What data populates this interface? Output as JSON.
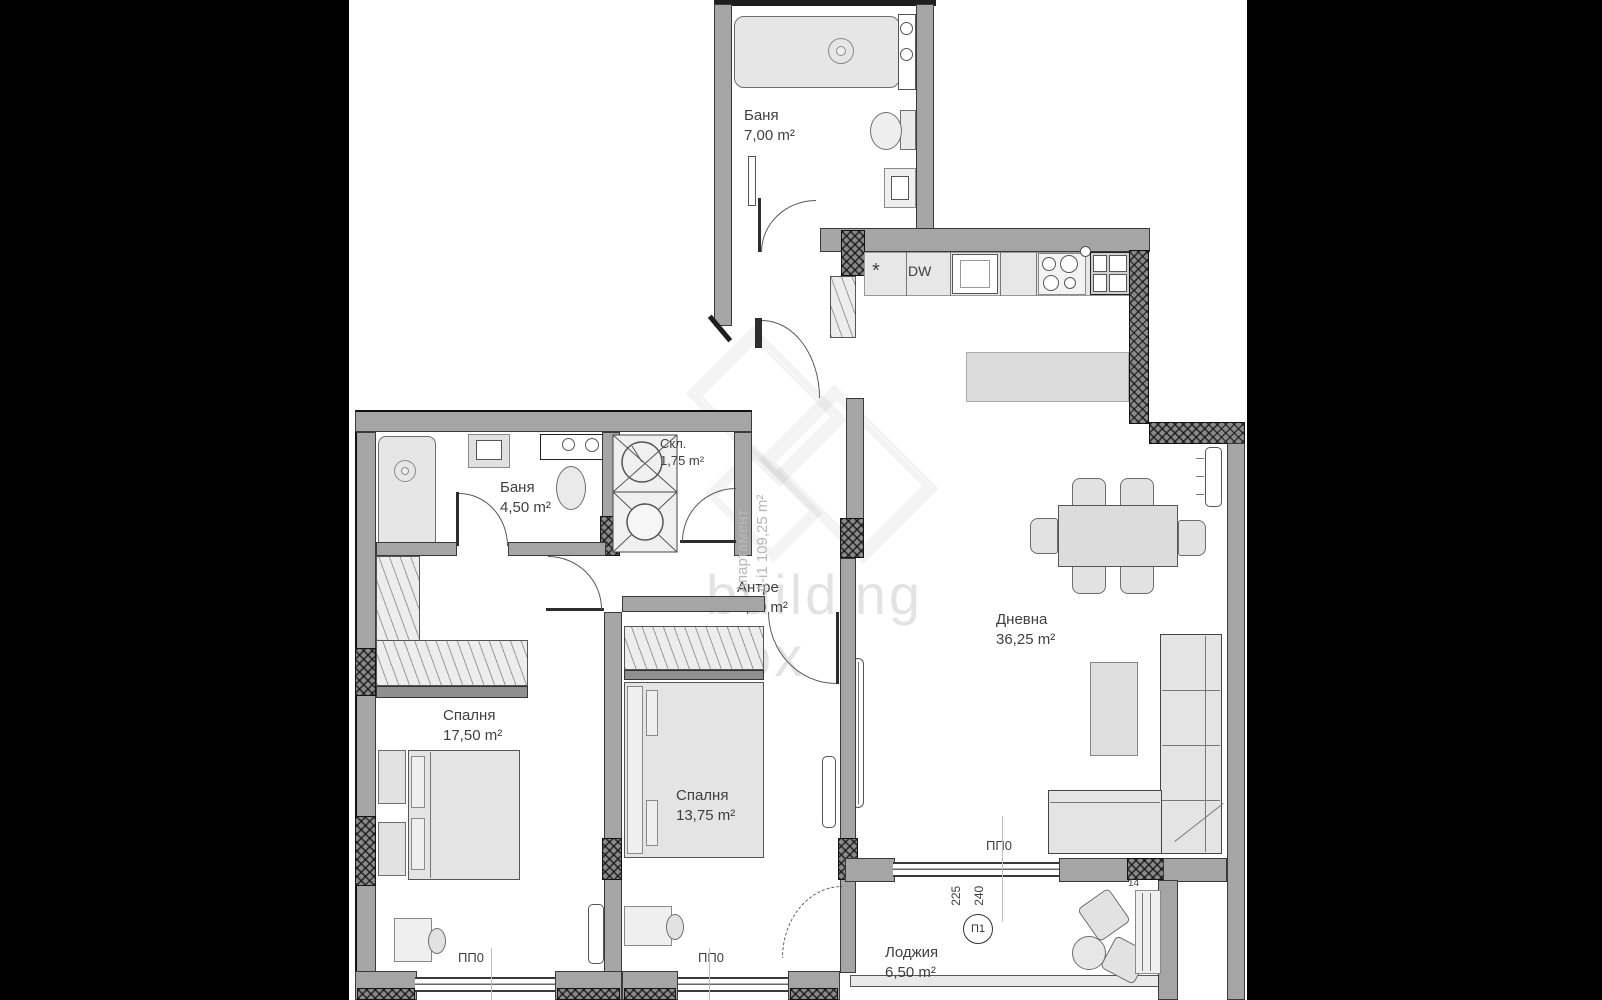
{
  "plan_title": "apartment floor plan",
  "colors": {
    "outside": "#000000",
    "plan_bg": "#ffffff",
    "wall": "#a5a5a5",
    "wall_dark": "#1e1e1e",
    "text": "#3f3f3f",
    "watermark": "#d9d9d9"
  },
  "watermark": {
    "line1": "building",
    "line2": "box"
  },
  "apartment": {
    "title": "Апартамент",
    "info": "А-і1 109,25 m²"
  },
  "rooms": {
    "bath_top": {
      "name": "Баня",
      "area": "7,00 m²"
    },
    "bath_small": {
      "name": "Баня",
      "area": "4,50 m²"
    },
    "storage": {
      "name": "Скл.",
      "area": "1,75 m²"
    },
    "hall": {
      "name": "Антре",
      "area": "8,50 m²"
    },
    "bedroom1": {
      "name": "Спалня",
      "area": "17,50 m²"
    },
    "bedroom2": {
      "name": "Спалня",
      "area": "13,75 m²"
    },
    "living": {
      "name": "Дневна",
      "area": "36,25 m²"
    },
    "loggia": {
      "name": "Лоджия",
      "area": "6,50 m²"
    }
  },
  "labels": {
    "dw": "DW",
    "star": "*",
    "pp0": "ПП0",
    "p1": "П1",
    "d225": "225",
    "d240": "240",
    "d14": "14"
  }
}
